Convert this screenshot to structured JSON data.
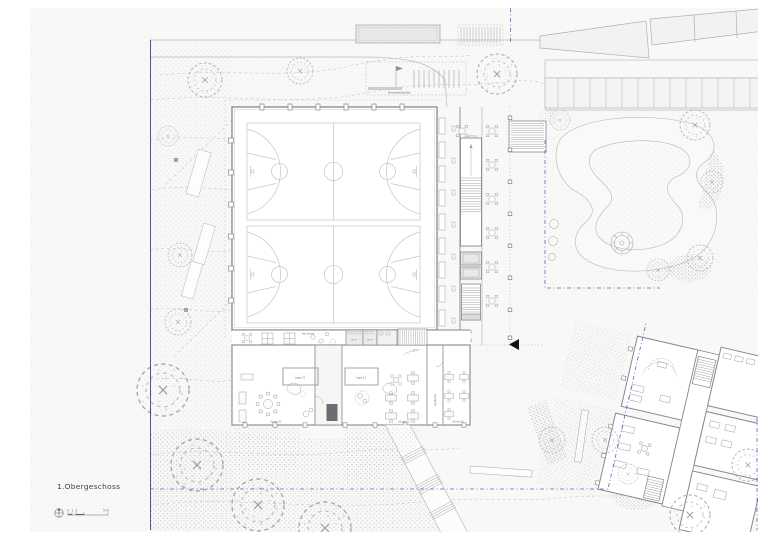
{
  "plan": {
    "title": "1.Obergeschoss",
    "type": "architectural floor plan / site plan"
  },
  "labels": {
    "lernraeume": "Lernräume",
    "lager10": "Lager 10",
    "lager11": "Lager 11",
    "kinder01": "Kinder 01",
    "kinder02": "Kinder 02",
    "kinder03": "Kinder 03",
    "garderobe": "Garderobe",
    "wc_d": "WC D",
    "wc_h": "WC H",
    "treppenhaus": "Treppenhaus",
    "fahrrad": "Fahrradabstellplätze",
    "level": "+0.50"
  },
  "scalebar": {
    "n0": "0",
    "n1": "1",
    "n2": "2",
    "n5": "5 m"
  },
  "colors": {
    "paper": "#f7f7f5",
    "line_light": "#b3b6bb",
    "wall": "#85888d",
    "court_line": "#c2c5ca",
    "boundary_blue_dashed": "#5d61c9",
    "boundary_blue_solid": "#3c4095",
    "entrance_marker": "#141418",
    "text": "#6a6d71"
  }
}
